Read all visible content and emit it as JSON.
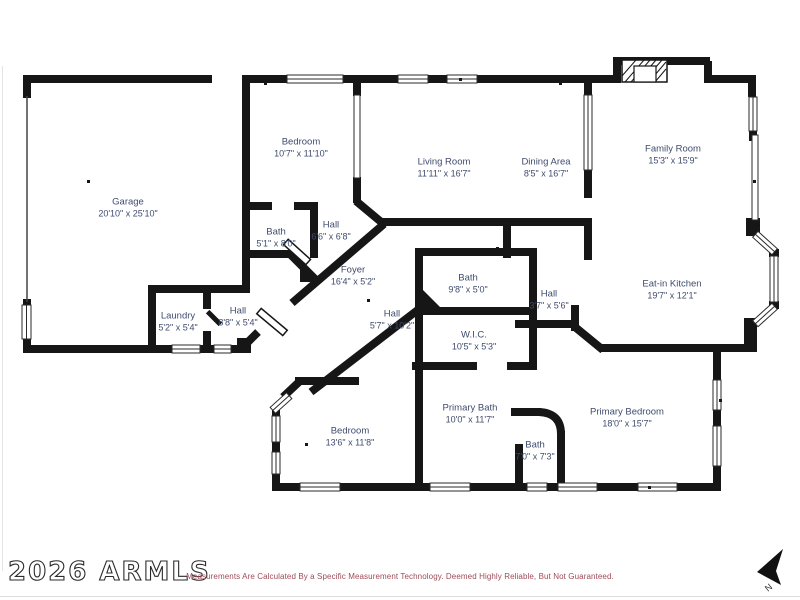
{
  "watermark": "2026 ARMLS",
  "disclaimer": "Measurements Are Calculated By a Specific Measurement Technology. Deemed Highly Reliable, But Not Guaranteed.",
  "compass": {
    "label": "N"
  },
  "colors": {
    "wall": "#161616",
    "room_label": "#3f4c6e",
    "disclaimer": "#a04b57",
    "background": "#ffffff"
  },
  "rooms": [
    {
      "name": "Garage",
      "dims": "20'10\" x 25'10\"",
      "x": 128,
      "y": 208
    },
    {
      "name": "Bedroom",
      "dims": "10'7\" x 11'10\"",
      "x": 301,
      "y": 148
    },
    {
      "name": "Bath",
      "dims": "5'1\" x 8'0\"",
      "x": 276,
      "y": 238
    },
    {
      "name": "Hall",
      "dims": "6'6\" x 6'8\"",
      "x": 331,
      "y": 231
    },
    {
      "name": "Living Room",
      "dims": "11'11\" x 16'7\"",
      "x": 444,
      "y": 168
    },
    {
      "name": "Dining Area",
      "dims": "8'5\" x 16'7\"",
      "x": 546,
      "y": 168
    },
    {
      "name": "Family Room",
      "dims": "15'3\" x 15'9\"",
      "x": 673,
      "y": 155
    },
    {
      "name": "Eat-in Kitchen",
      "dims": "19'7\" x 12'1\"",
      "x": 672,
      "y": 290
    },
    {
      "name": "Foyer",
      "dims": "16'4\" x 5'2\"",
      "x": 353,
      "y": 276
    },
    {
      "name": "Laundry",
      "dims": "5'2\" x 5'4\"",
      "x": 178,
      "y": 322
    },
    {
      "name": "Hall",
      "dims": "8'8\" x 5'4\"",
      "x": 238,
      "y": 317
    },
    {
      "name": "Hall",
      "dims": "5'7\" x 10'2\"",
      "x": 392,
      "y": 320
    },
    {
      "name": "Bath",
      "dims": "9'8\" x 5'0\"",
      "x": 468,
      "y": 284
    },
    {
      "name": "Hall",
      "dims": "3'7\" x 5'6\"",
      "x": 549,
      "y": 300
    },
    {
      "name": "W.I.C.",
      "dims": "10'5\" x 5'3\"",
      "x": 474,
      "y": 341
    },
    {
      "name": "Bedroom",
      "dims": "13'6\" x 11'8\"",
      "x": 350,
      "y": 437
    },
    {
      "name": "Primary Bath",
      "dims": "10'0\" x 11'7\"",
      "x": 470,
      "y": 414
    },
    {
      "name": "Bath",
      "dims": "7'0\" x 7'3\"",
      "x": 535,
      "y": 451
    },
    {
      "name": "Primary Bedroom",
      "dims": "18'0\" x 15'7\"",
      "x": 627,
      "y": 418
    }
  ]
}
